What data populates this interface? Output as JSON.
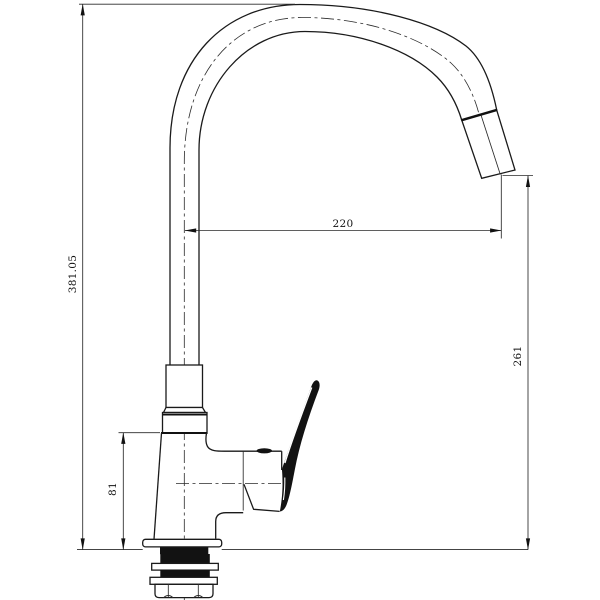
{
  "page": {
    "background": "#ffffff",
    "line_color": "#1a1a1a"
  },
  "drawing": {
    "type": "technical-dimension-drawing",
    "subject": "gooseneck kitchen faucet, side elevation",
    "dimensions": {
      "overall_height": {
        "label": "381.05",
        "orientation": "vertical"
      },
      "spout_reach": {
        "label": "220",
        "orientation": "horizontal"
      },
      "outlet_height": {
        "label": "261",
        "orientation": "vertical"
      },
      "body_height": {
        "label": "81",
        "orientation": "vertical"
      }
    }
  }
}
